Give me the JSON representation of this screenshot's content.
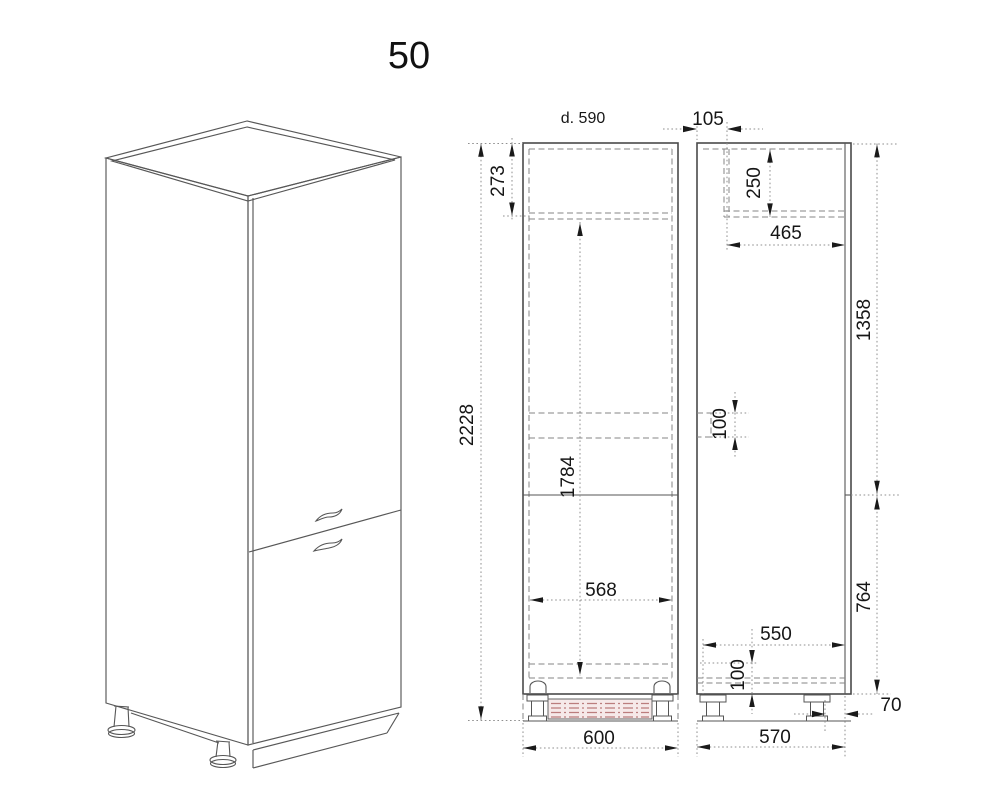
{
  "page": {
    "title": "50"
  },
  "labels": {
    "depth": "d. 590",
    "top_offset": "105",
    "top_panel": "273",
    "top_niche": "250",
    "top_depth": "465",
    "total_height": "2228",
    "upper_door": "1358",
    "vent_niche": "100",
    "niche_height": "1784",
    "inner_width": "568",
    "plinth_depth": "550",
    "lower_door": "764",
    "base_height": "100",
    "toe_kick": "70",
    "width": "600",
    "body_depth": "570"
  },
  "colors": {
    "line": "#4a4a4a",
    "dashed_line": "#858585",
    "dimension_line": "#8f8f8f",
    "text": "#161616",
    "plinth_fill": "#f6e9e9",
    "plinth_hatch": "#bb7d7d"
  }
}
